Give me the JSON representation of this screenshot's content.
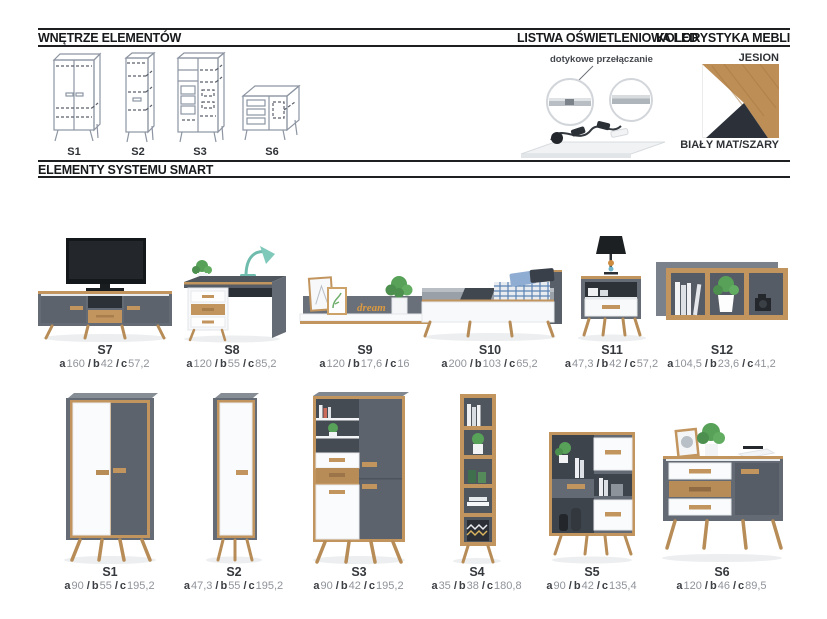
{
  "titles": {
    "interior": "WNĘTRZE ELEMENTÓW",
    "led": "LISTWA OŚWIETLENIOWA LED",
    "colors": "KOLORYSTYKA MEBLI",
    "system": "ELEMENTY SYSTEMU SMART"
  },
  "led": {
    "caption": "dotykowe przełączanie"
  },
  "colors": {
    "wood_label": "JESION",
    "body_label": "BIAŁY MAT/SZARY",
    "wood_hex": "#bd8e55",
    "white_hex": "#ffffff",
    "dark_hex": "#2c3139"
  },
  "interior_drawings": [
    {
      "label": "S1"
    },
    {
      "label": "S2"
    },
    {
      "label": "S3"
    },
    {
      "label": "S6"
    }
  ],
  "dim_labels": {
    "a": "a",
    "b": "b",
    "c": "c",
    "sep": "/"
  },
  "decor": {
    "s9_sign": "dream"
  },
  "products": [
    {
      "name": "S7",
      "a": "160",
      "b": "42",
      "c": "57,2"
    },
    {
      "name": "S8",
      "a": "120",
      "b": "55",
      "c": "85,2"
    },
    {
      "name": "S9",
      "a": "120",
      "b": "17,6",
      "c": "16"
    },
    {
      "name": "S10",
      "a": "200",
      "b": "103",
      "c": "65,2"
    },
    {
      "name": "S11",
      "a": "47,3",
      "b": "42",
      "c": "57,2"
    },
    {
      "name": "S12",
      "a": "104,5",
      "b": "23,6",
      "c": "41,2"
    },
    {
      "name": "S1",
      "a": "90",
      "b": "55",
      "c": "195,2"
    },
    {
      "name": "S2",
      "a": "47,3",
      "b": "55",
      "c": "195,2"
    },
    {
      "name": "S3",
      "a": "90",
      "b": "42",
      "c": "195,2"
    },
    {
      "name": "S4",
      "a": "35",
      "b": "38",
      "c": "180,8"
    },
    {
      "name": "S5",
      "a": "90",
      "b": "42",
      "c": "135,4"
    },
    {
      "name": "S6",
      "a": "120",
      "b": "46",
      "c": "89,5"
    }
  ]
}
